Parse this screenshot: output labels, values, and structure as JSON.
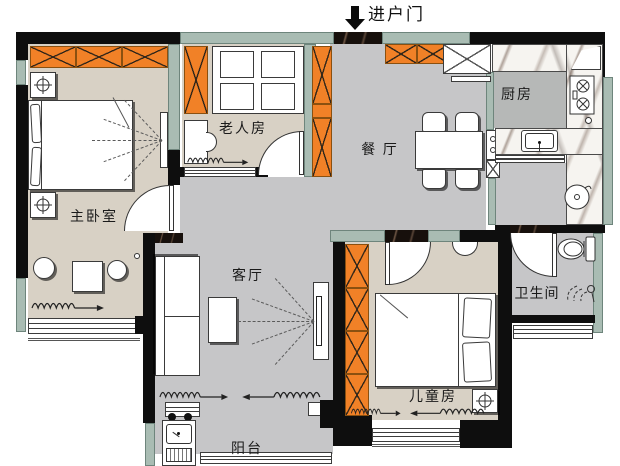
{
  "title": "三室两厅户型平面图",
  "entry": {
    "label": "进户门"
  },
  "rooms": {
    "master": {
      "label": "主卧室"
    },
    "elder": {
      "label": "老人房"
    },
    "dining": {
      "label": "餐 厅"
    },
    "kitchen": {
      "label": "厨房"
    },
    "bath": {
      "label": "卫生间"
    },
    "living": {
      "label": "客厅"
    },
    "kids": {
      "label": "儿童房"
    },
    "balcony": {
      "label": "阳台"
    }
  },
  "colors": {
    "orange": "#F18127",
    "sage": "#A9BCB3",
    "wall": "#0E0E0E",
    "beige": "#D8D1C5",
    "gray": "#C6C6C8",
    "grayDark": "#B6B8B7",
    "marbleDark": "#17100C"
  }
}
